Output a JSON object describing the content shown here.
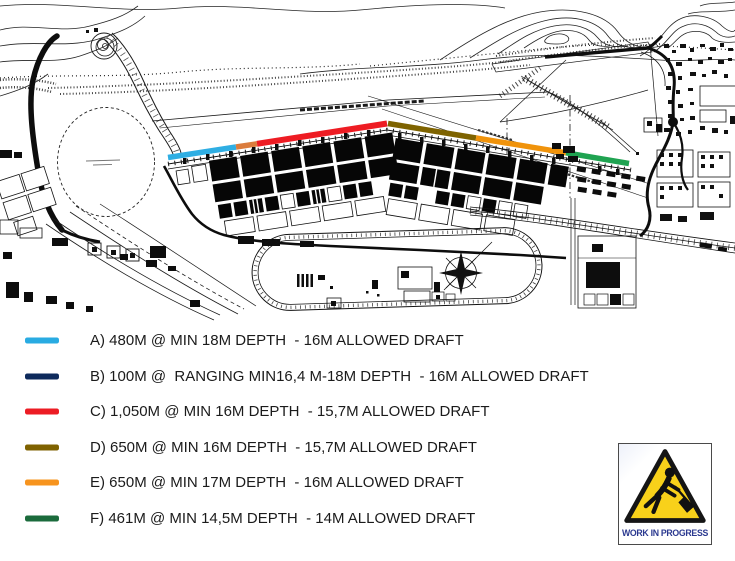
{
  "legend": {
    "items": [
      {
        "id": "A",
        "color": "#29ABE2",
        "label": "A) 480M @ MIN 18M DEPTH  - 16M ALLOWED DRAFT"
      },
      {
        "id": "B",
        "color": "#0E2A5C",
        "label": "B) 100M @  RANGING MIN16,4 M-18M DEPTH  - 16M ALLOWED DRAFT"
      },
      {
        "id": "C",
        "color": "#EC1C24",
        "label": "C) 1,050M @ MIN 16M DEPTH  - 15,7M ALLOWED DRAFT"
      },
      {
        "id": "D",
        "color": "#7F6200",
        "label": "D) 650M @ MIN 16M DEPTH  - 15,7M ALLOWED DRAFT"
      },
      {
        "id": "E",
        "color": "#F7941E",
        "label": "E) 650M @ MIN 17M DEPTH  - 16M ALLOWED DRAFT"
      },
      {
        "id": "F",
        "color": "#1B6B3C",
        "label": "F) 461M @ MIN 14,5M DEPTH  - 14M ALLOWED DRAFT"
      }
    ]
  },
  "map": {
    "quay_segments": [
      {
        "id": "A",
        "color": "#2FAEE3"
      },
      {
        "id": "B",
        "color": "#DB7C3D"
      },
      {
        "id": "C",
        "color": "#EE1C23"
      },
      {
        "id": "D",
        "color": "#7E6300"
      },
      {
        "id": "E",
        "color": "#F0930B"
      },
      {
        "id": "F",
        "color": "#1FA351"
      }
    ]
  },
  "sign": {
    "label": "WORK IN PROGRESS",
    "triangle_color": "#F8D11A",
    "text_color": "#2B3990"
  }
}
